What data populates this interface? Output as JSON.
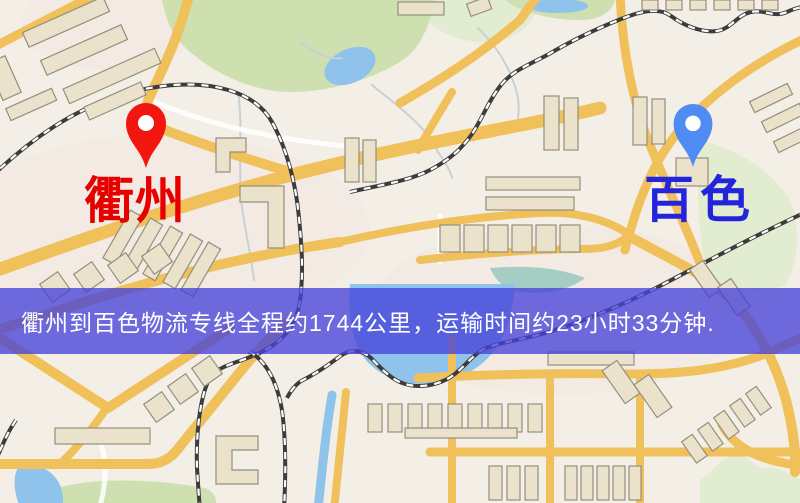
{
  "map": {
    "markers": {
      "origin": {
        "label": "衢州",
        "pin_color": "#f2170e",
        "label_color": "#e80000"
      },
      "destination": {
        "label": "百色",
        "pin_color": "#4e8bf2",
        "label_color": "#2424dd"
      }
    },
    "banner": {
      "text": "衢州到百色物流专线全程约1744公里，运输时间约23小时33分钟.",
      "background_color": "rgba(71,67,216,0.78)",
      "text_color": "#ffffff"
    },
    "palette": {
      "background": "#f4efe6",
      "tint": "#f2e5e0",
      "road": "#f0c05a",
      "minor_road": "#ffffff",
      "water": "#8fc3ec",
      "water_teal": "#a6cdc3",
      "park": "#cfe0b0",
      "park_light": "#e2ecd0",
      "building": "#eae2ca",
      "building_border": "#948f7d",
      "railway_dark": "#3c3c3c",
      "railway_light": "#ffffff",
      "stream": "#c6d1d6"
    }
  }
}
